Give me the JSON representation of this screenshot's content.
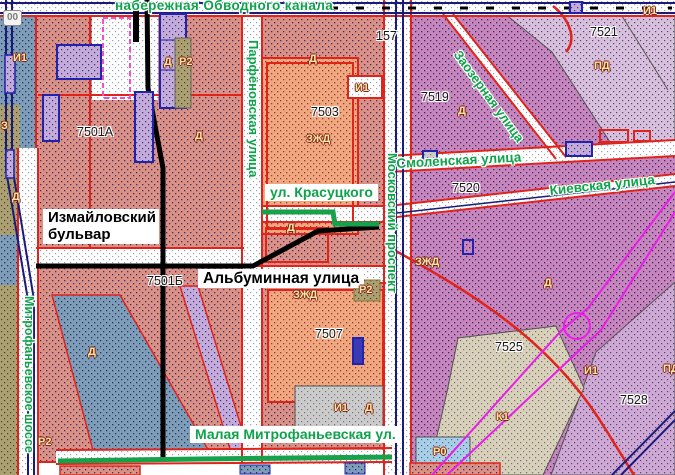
{
  "map": {
    "kind": "cadastral zoning map",
    "streets_green": [
      {
        "text": "набережная Обводного канала"
      },
      {
        "text": "Парфёновская улица"
      },
      {
        "text": "Московский проспект"
      },
      {
        "text": "Митрофаньевское шоссе"
      },
      {
        "text": "ул. Красуцкого"
      },
      {
        "text": "Смоленская улица"
      },
      {
        "text": "Киевская улица"
      },
      {
        "text": "Заозерная улица"
      },
      {
        "text": "Малая Митрофаньевская ул."
      }
    ],
    "streets_black": [
      {
        "text": "Измайловский бульвар"
      },
      {
        "text": "Альбуминная улица"
      }
    ],
    "parcel_numbers": [
      {
        "text": "7501А"
      },
      {
        "text": "7501Б"
      },
      {
        "text": "7503"
      },
      {
        "text": "7507"
      },
      {
        "text": "7519"
      },
      {
        "text": "7520"
      },
      {
        "text": "7521"
      },
      {
        "text": "7525"
      },
      {
        "text": "7528"
      },
      {
        "text": "157"
      },
      {
        "text": "00"
      }
    ],
    "zone_codes": [
      {
        "text": "И1"
      },
      {
        "text": "Д"
      },
      {
        "text": "Р2"
      },
      {
        "text": "Д"
      },
      {
        "text": "Д"
      },
      {
        "text": "И1"
      },
      {
        "text": "ЗЖД"
      },
      {
        "text": "З"
      },
      {
        "text": "Д"
      },
      {
        "text": "Д"
      },
      {
        "text": "ЗЖД"
      },
      {
        "text": "Р2"
      },
      {
        "text": "Д"
      },
      {
        "text": "Р2"
      },
      {
        "text": "И1"
      },
      {
        "text": "Д"
      },
      {
        "text": "ЗЖД"
      },
      {
        "text": "Д"
      },
      {
        "text": "ПД"
      },
      {
        "text": "И1"
      },
      {
        "text": "Д"
      },
      {
        "text": "И1"
      },
      {
        "text": "ПД"
      },
      {
        "text": "К1"
      },
      {
        "text": "Р0"
      }
    ],
    "colors": {
      "street_name_green": "#0EA34B",
      "parcel_line_red": "#E0241B",
      "building_blue": "#2222AA",
      "rail_navy": "#1A1A7A",
      "metro_magenta": "#E81FE8",
      "zone_code_fill": "#F4E9A0",
      "zone_residential_salmon": "#DC9187",
      "zone_business_magenta": "#C985BD",
      "zone_industrial_orange": "#F2A87E"
    }
  }
}
